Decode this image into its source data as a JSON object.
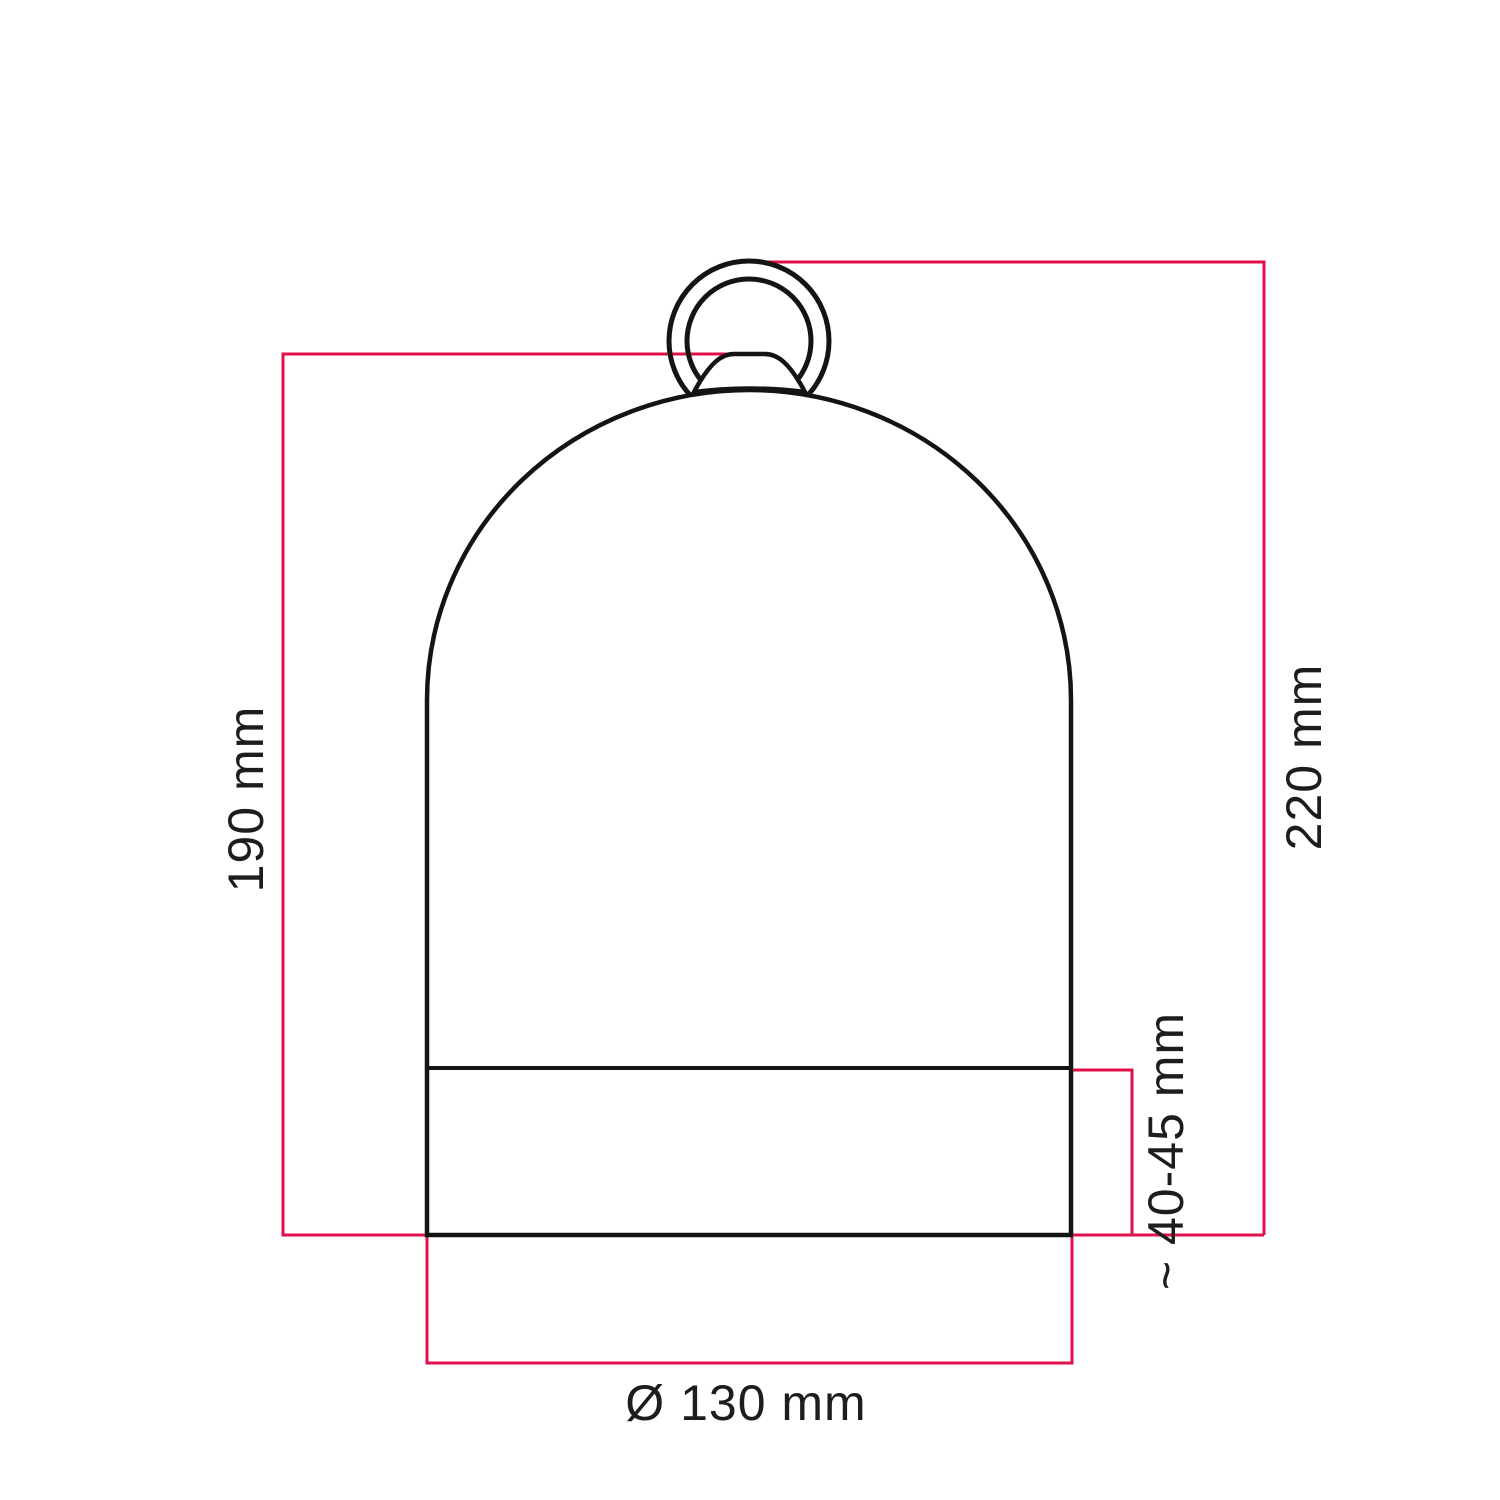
{
  "colors": {
    "accent": "#e0104b",
    "line": "#141414",
    "text": "#1d1d1b",
    "background": "#ffffff"
  },
  "dimensions": {
    "body_height": "190 mm",
    "total_height": "220 mm",
    "base_height": "~ 40-45 mm",
    "diameter": "Ø 130 mm"
  }
}
